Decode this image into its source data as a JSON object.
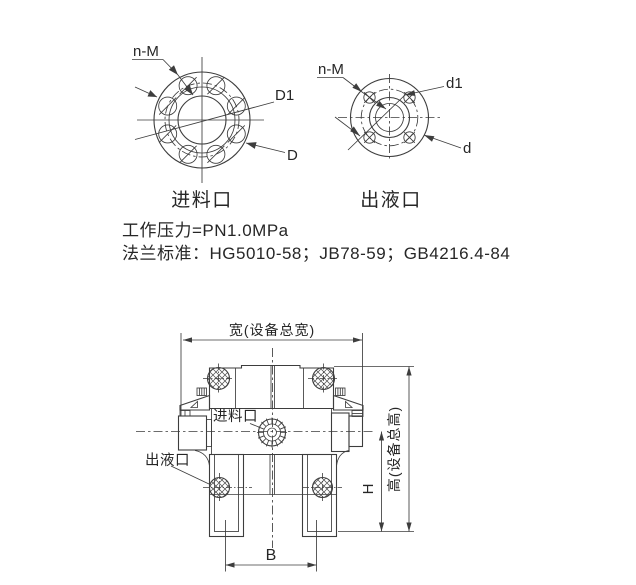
{
  "flange_views": {
    "inlet": {
      "caption": "进料口",
      "bolt_label": "n-M",
      "bolt_circle_label": "D1",
      "outer_label": "D"
    },
    "outlet": {
      "caption": "出液口",
      "bolt_label": "n-M",
      "bolt_circle_label": "d1",
      "outer_label": "d"
    }
  },
  "specs": {
    "working_pressure": "工作压力=PN1.0MPa",
    "flange_standards": "法兰标准：HG5010-58；JB78-59；GB4216.4-84"
  },
  "side_view": {
    "width_label": "宽(设备总宽)",
    "total_height_label": "高(设备总高)",
    "height_label": "H",
    "base_label": "B",
    "inlet_label": "进料口",
    "outlet_label": "出液口"
  },
  "colors": {
    "line": "#3d3d3d",
    "text": "#262626",
    "background": "#ffffff"
  }
}
